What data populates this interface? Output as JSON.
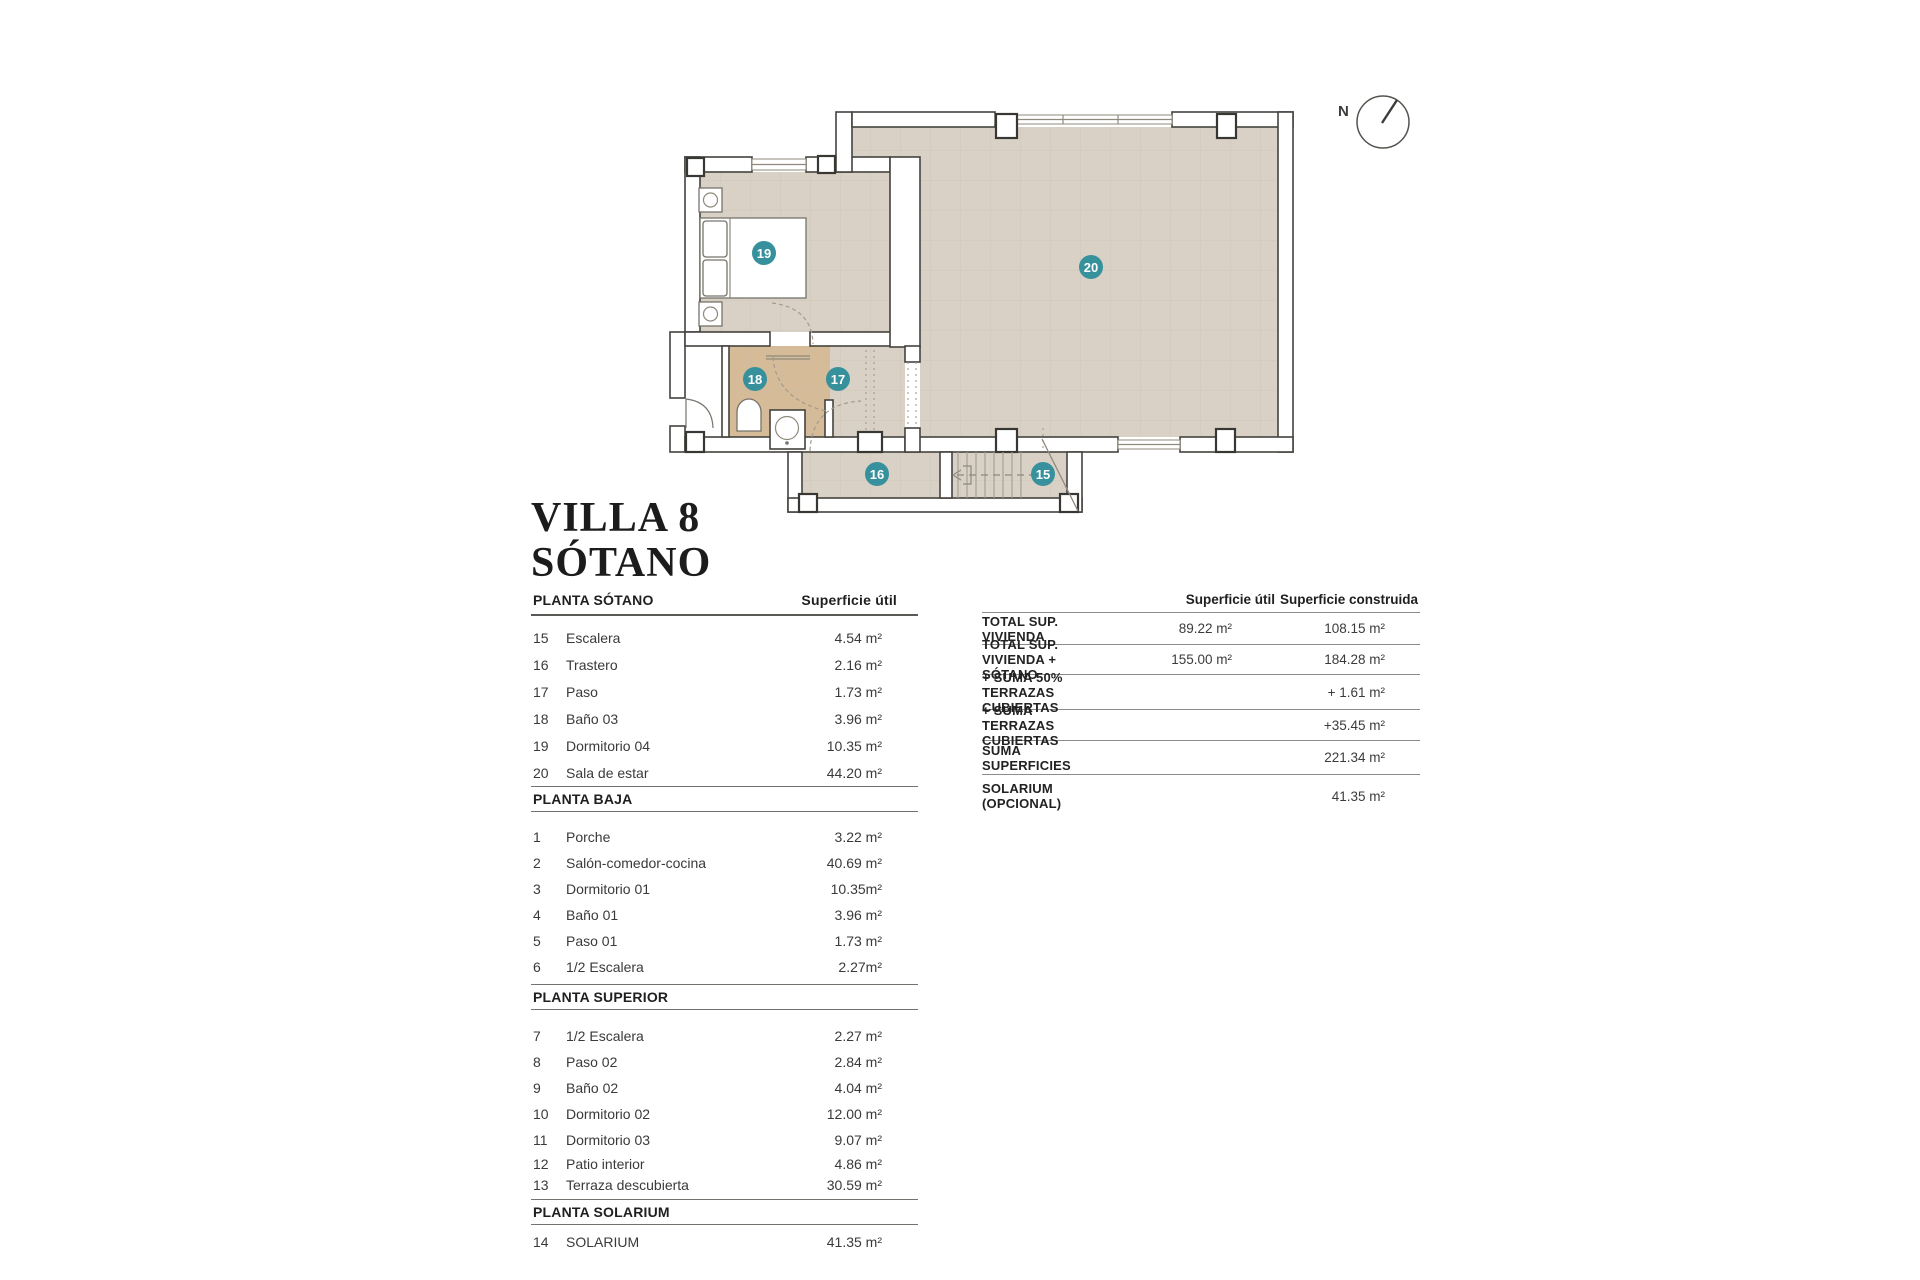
{
  "title": {
    "line1": "VILLA 8",
    "line2": "SÓTANO"
  },
  "plan": {
    "compass_label": "N",
    "badges": [
      "15",
      "16",
      "17",
      "18",
      "19",
      "20"
    ]
  },
  "left_table": {
    "sections": [
      {
        "header": "PLANTA SÓTANO",
        "col_header": "Superficie útil",
        "rows": [
          [
            "15",
            "Escalera",
            "4.54 m²"
          ],
          [
            "16",
            "Trastero",
            "2.16 m²"
          ],
          [
            "17",
            "Paso",
            "1.73 m²"
          ],
          [
            "18",
            "Baño 03",
            "3.96 m²"
          ],
          [
            "19",
            "Dormitorio 04",
            "10.35 m²"
          ],
          [
            "20",
            "Sala de estar",
            "44.20 m²"
          ]
        ]
      },
      {
        "header": "PLANTA BAJA",
        "rows": [
          [
            "1",
            "Porche",
            "3.22 m²"
          ],
          [
            "2",
            "Salón-comedor-cocina",
            "40.69 m²"
          ],
          [
            "3",
            "Dormitorio 01",
            "10.35m²"
          ],
          [
            "4",
            "Baño 01",
            "3.96 m²"
          ],
          [
            "5",
            "Paso 01",
            "1.73 m²"
          ],
          [
            "6",
            "1/2 Escalera",
            "2.27m²"
          ]
        ]
      },
      {
        "header": "PLANTA SUPERIOR",
        "rows": [
          [
            "7",
            "1/2 Escalera",
            "2.27 m²"
          ],
          [
            "8",
            "Paso 02",
            "2.84 m²"
          ],
          [
            "9",
            "Baño 02",
            "4.04 m²"
          ],
          [
            "10",
            "Dormitorio 02",
            "12.00 m²"
          ],
          [
            "11",
            "Dormitorio 03",
            "9.07 m²"
          ],
          [
            "12",
            "Patio interior",
            "4.86 m²"
          ],
          [
            "13",
            "Terraza descubierta",
            "30.59 m²"
          ]
        ]
      },
      {
        "header": "PLANTA SOLARIUM",
        "rows": [
          [
            "14",
            "SOLARIUM",
            "41.35 m²"
          ]
        ]
      }
    ]
  },
  "summary_table": {
    "col1_header": "Superficie útil",
    "col2_header": "Superficie construida",
    "rows": [
      {
        "label": "TOTAL SUP. VIVIENDA",
        "util": "89.22 m²",
        "construida": "108.15 m²"
      },
      {
        "label": "TOTAL SUP. VIVIENDA + SÓTANO",
        "util": "155.00 m²",
        "construida": "184.28 m²"
      },
      {
        "label": "+ SUMA 50% TERRAZAS CUBIERTAS",
        "util": "",
        "construida": "+ 1.61 m²"
      },
      {
        "label": "+ SUMA TERRAZAS CUBIERTAS",
        "util": "",
        "construida": "+35.45 m²"
      },
      {
        "label": "SUMA SUPERFICIES",
        "util": "",
        "construida": "221.34 m²"
      },
      {
        "label": "SOLARIUM (OPCIONAL)",
        "util": "",
        "construida": "41.35 m²"
      }
    ]
  },
  "colors": {
    "floor": "#d9d1c5",
    "bath_floor": "#d5bb97",
    "badge_teal": "#37919c",
    "wall_outline": "#45433f"
  }
}
